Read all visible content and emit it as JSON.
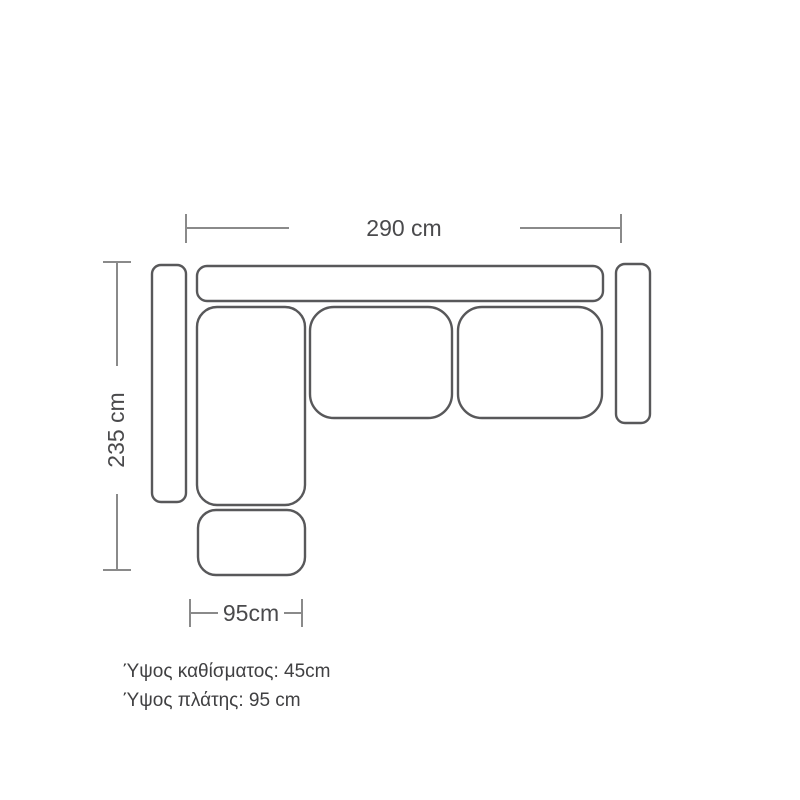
{
  "diagram": {
    "type": "corner-sofa-top-view-dimension-drawing",
    "dimensions": {
      "total_width": {
        "label": "290 cm",
        "value": 290,
        "unit": "cm"
      },
      "total_depth": {
        "label": "235 cm",
        "value": 235,
        "unit": "cm"
      },
      "chaise_width": {
        "label": "95cm",
        "value": 95,
        "unit": "cm"
      }
    },
    "notes": [
      "Ύψος καθίσματος: 45cm",
      "Ύψος πλάτης: 95 cm"
    ],
    "parts": [
      "backrest",
      "left-armrest",
      "right-armrest",
      "chaise-seat",
      "seat-cushion-middle",
      "seat-cushion-right",
      "ottoman"
    ],
    "colors": {
      "outline": "#58585a",
      "dimension_line": "#8a8a8a",
      "label_text": "#4a4a4c",
      "background": "#ffffff"
    }
  }
}
